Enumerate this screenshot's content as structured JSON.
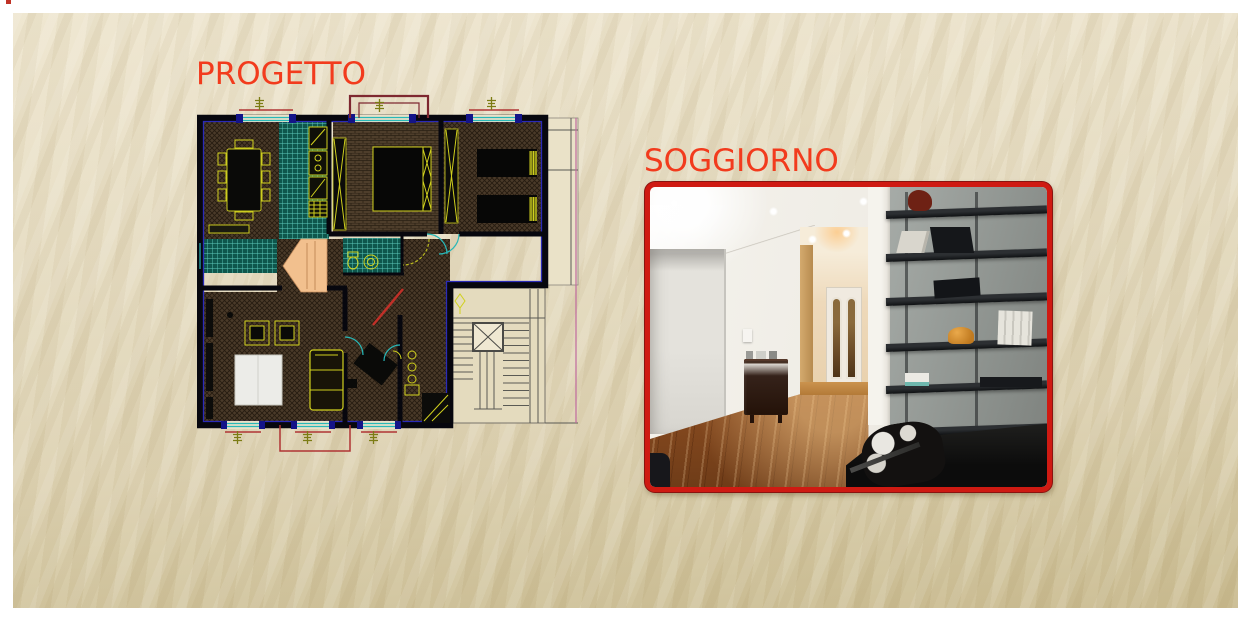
{
  "theme": {
    "page_bg": "#ffffff",
    "slide_top": "#eee6cf",
    "slide_mid": "#ddd2b2",
    "slide_bottom": "#cabc91",
    "title_color": "#f23b1d",
    "photo_border": "#cf1a12",
    "plan_wall": "#07070e",
    "plan_navy": "#2a2ab8",
    "plan_yellow": "#d0d01e",
    "plan_teal": "#28b8b8",
    "plan_olive": "#7c7c14",
    "plan_red": "#b03434",
    "plan_maroon": "#7e2830",
    "plan_gray": "#5a5a54",
    "plan_pink": "#c06a9e"
  },
  "slide": {
    "floor_plan_title": "PROGETTO",
    "photo_title": "SOGGIORNO"
  }
}
